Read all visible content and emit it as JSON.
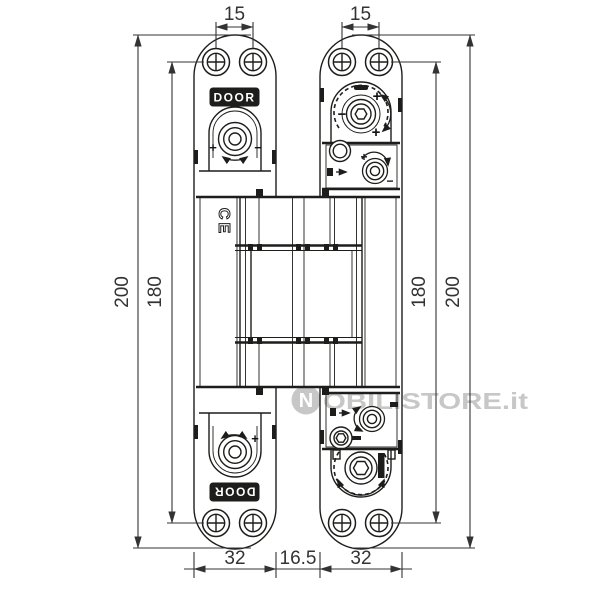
{
  "drawing": {
    "type": "technical-drawing",
    "subject": "concealed door hinge front view with mounting dimensions",
    "line_color": "#1d1d1b",
    "dimension_color": "#333333",
    "watermark": {
      "logo_letter": "N",
      "text": "OBILISTORE.it",
      "color": "#c7c7c7"
    },
    "labels": {
      "door_badge_top": "DOOR",
      "door_badge_bottom": "DOOR",
      "ce_mark": "CE"
    },
    "symbols": {
      "plus": "+",
      "minus": "−"
    },
    "dimensions": {
      "screw_spacing_left": "15",
      "screw_spacing_right": "15",
      "overall_height_left": "200",
      "screw_height_left": "180",
      "screw_height_right": "180",
      "overall_height_right": "200",
      "leaf_width_left": "32",
      "gap_width": "16.5",
      "leaf_width_right": "32"
    }
  }
}
